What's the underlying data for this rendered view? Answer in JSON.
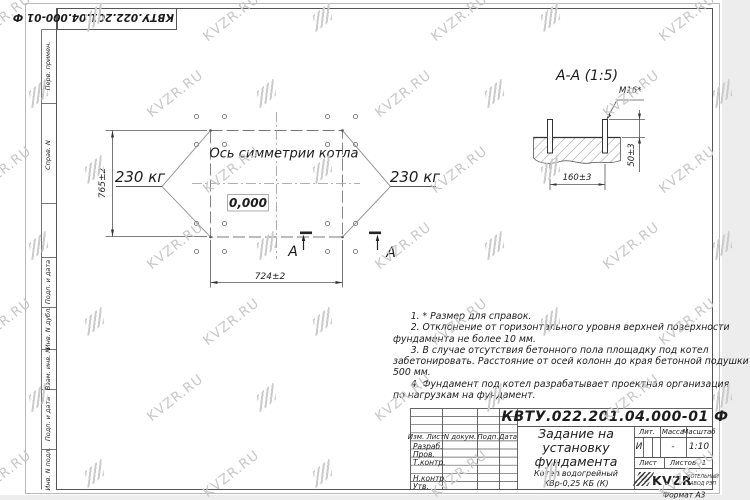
{
  "sheet": {
    "format_label": "Формат А3"
  },
  "stamp_top": {
    "doc_number": "КВТУ.022.201.04.000-01 Ф"
  },
  "left_strip": {
    "labels": [
      "Перв. примен.",
      "Справ. N",
      "Подп. и дата",
      "Инв. N дубл.",
      "Взам. инв. N",
      "Подп. и дата",
      "Инв. N подл."
    ]
  },
  "watermark": {
    "text": "KVZR.RU",
    "color": "#c7c7c7"
  },
  "plan": {
    "symmetry_axis_label": "Ось симметрии котла",
    "load_left": "230 кг",
    "load_right": "230 кг",
    "elevation_mark": "0,000",
    "dim_vertical": "765±2",
    "dim_horizontal": "724±2",
    "section_mark_left": "А",
    "section_mark_right": "А"
  },
  "section_view": {
    "title": "А-А (1:5)",
    "thread_callout": "М16*",
    "dim_bolt_height": "50±3",
    "dim_bolt_spacing": "160±3"
  },
  "notes": {
    "lines": [
      "      1. * Размер для справок.",
      "      2. Отклонение от горизонтального уровня верхней поверхности",
      "фундамента не более 10 мм.",
      "      3. В случае отсутствия бетонного пола площадку под котел",
      "забетонировать. Расстояние от осей колонн до края бетонной подушки",
      "500 мм.",
      "      4. Фундамент под котел разрабатывает проектная организация",
      "по нагрузкам на фундамент."
    ]
  },
  "title_block": {
    "doc_number": "КВТУ.022.201.04.000-01 Ф",
    "title_lines": [
      "Задание на",
      "установку",
      "фундамента"
    ],
    "product_lines": [
      "Котел водогрейный",
      "КВр-0,25 КБ (К)"
    ],
    "col_headers": {
      "izm": "Изм. Лист",
      "doc": "N докум.",
      "sign": "Подп.",
      "date": "Дата"
    },
    "row_labels": {
      "developer": "Разраб.",
      "checker": "Пров.",
      "tcontrol": "Т.контр.",
      "ncontrol": "Н.контр.",
      "approver": "Утв."
    },
    "props": {
      "lit_header": "Лит.",
      "mass_header": "Масса",
      "scale_header": "Масштаб",
      "lit": "И",
      "mass": "-",
      "scale": "1:10",
      "sheet_header": "Лист",
      "sheets_header": "Листов",
      "sheets_count": "1"
    },
    "logo": {
      "name": "KVZR",
      "caption_line1": "КОТЕЛЬНЫЙ",
      "caption_line2": "ЗАВОД РЭП"
    }
  }
}
